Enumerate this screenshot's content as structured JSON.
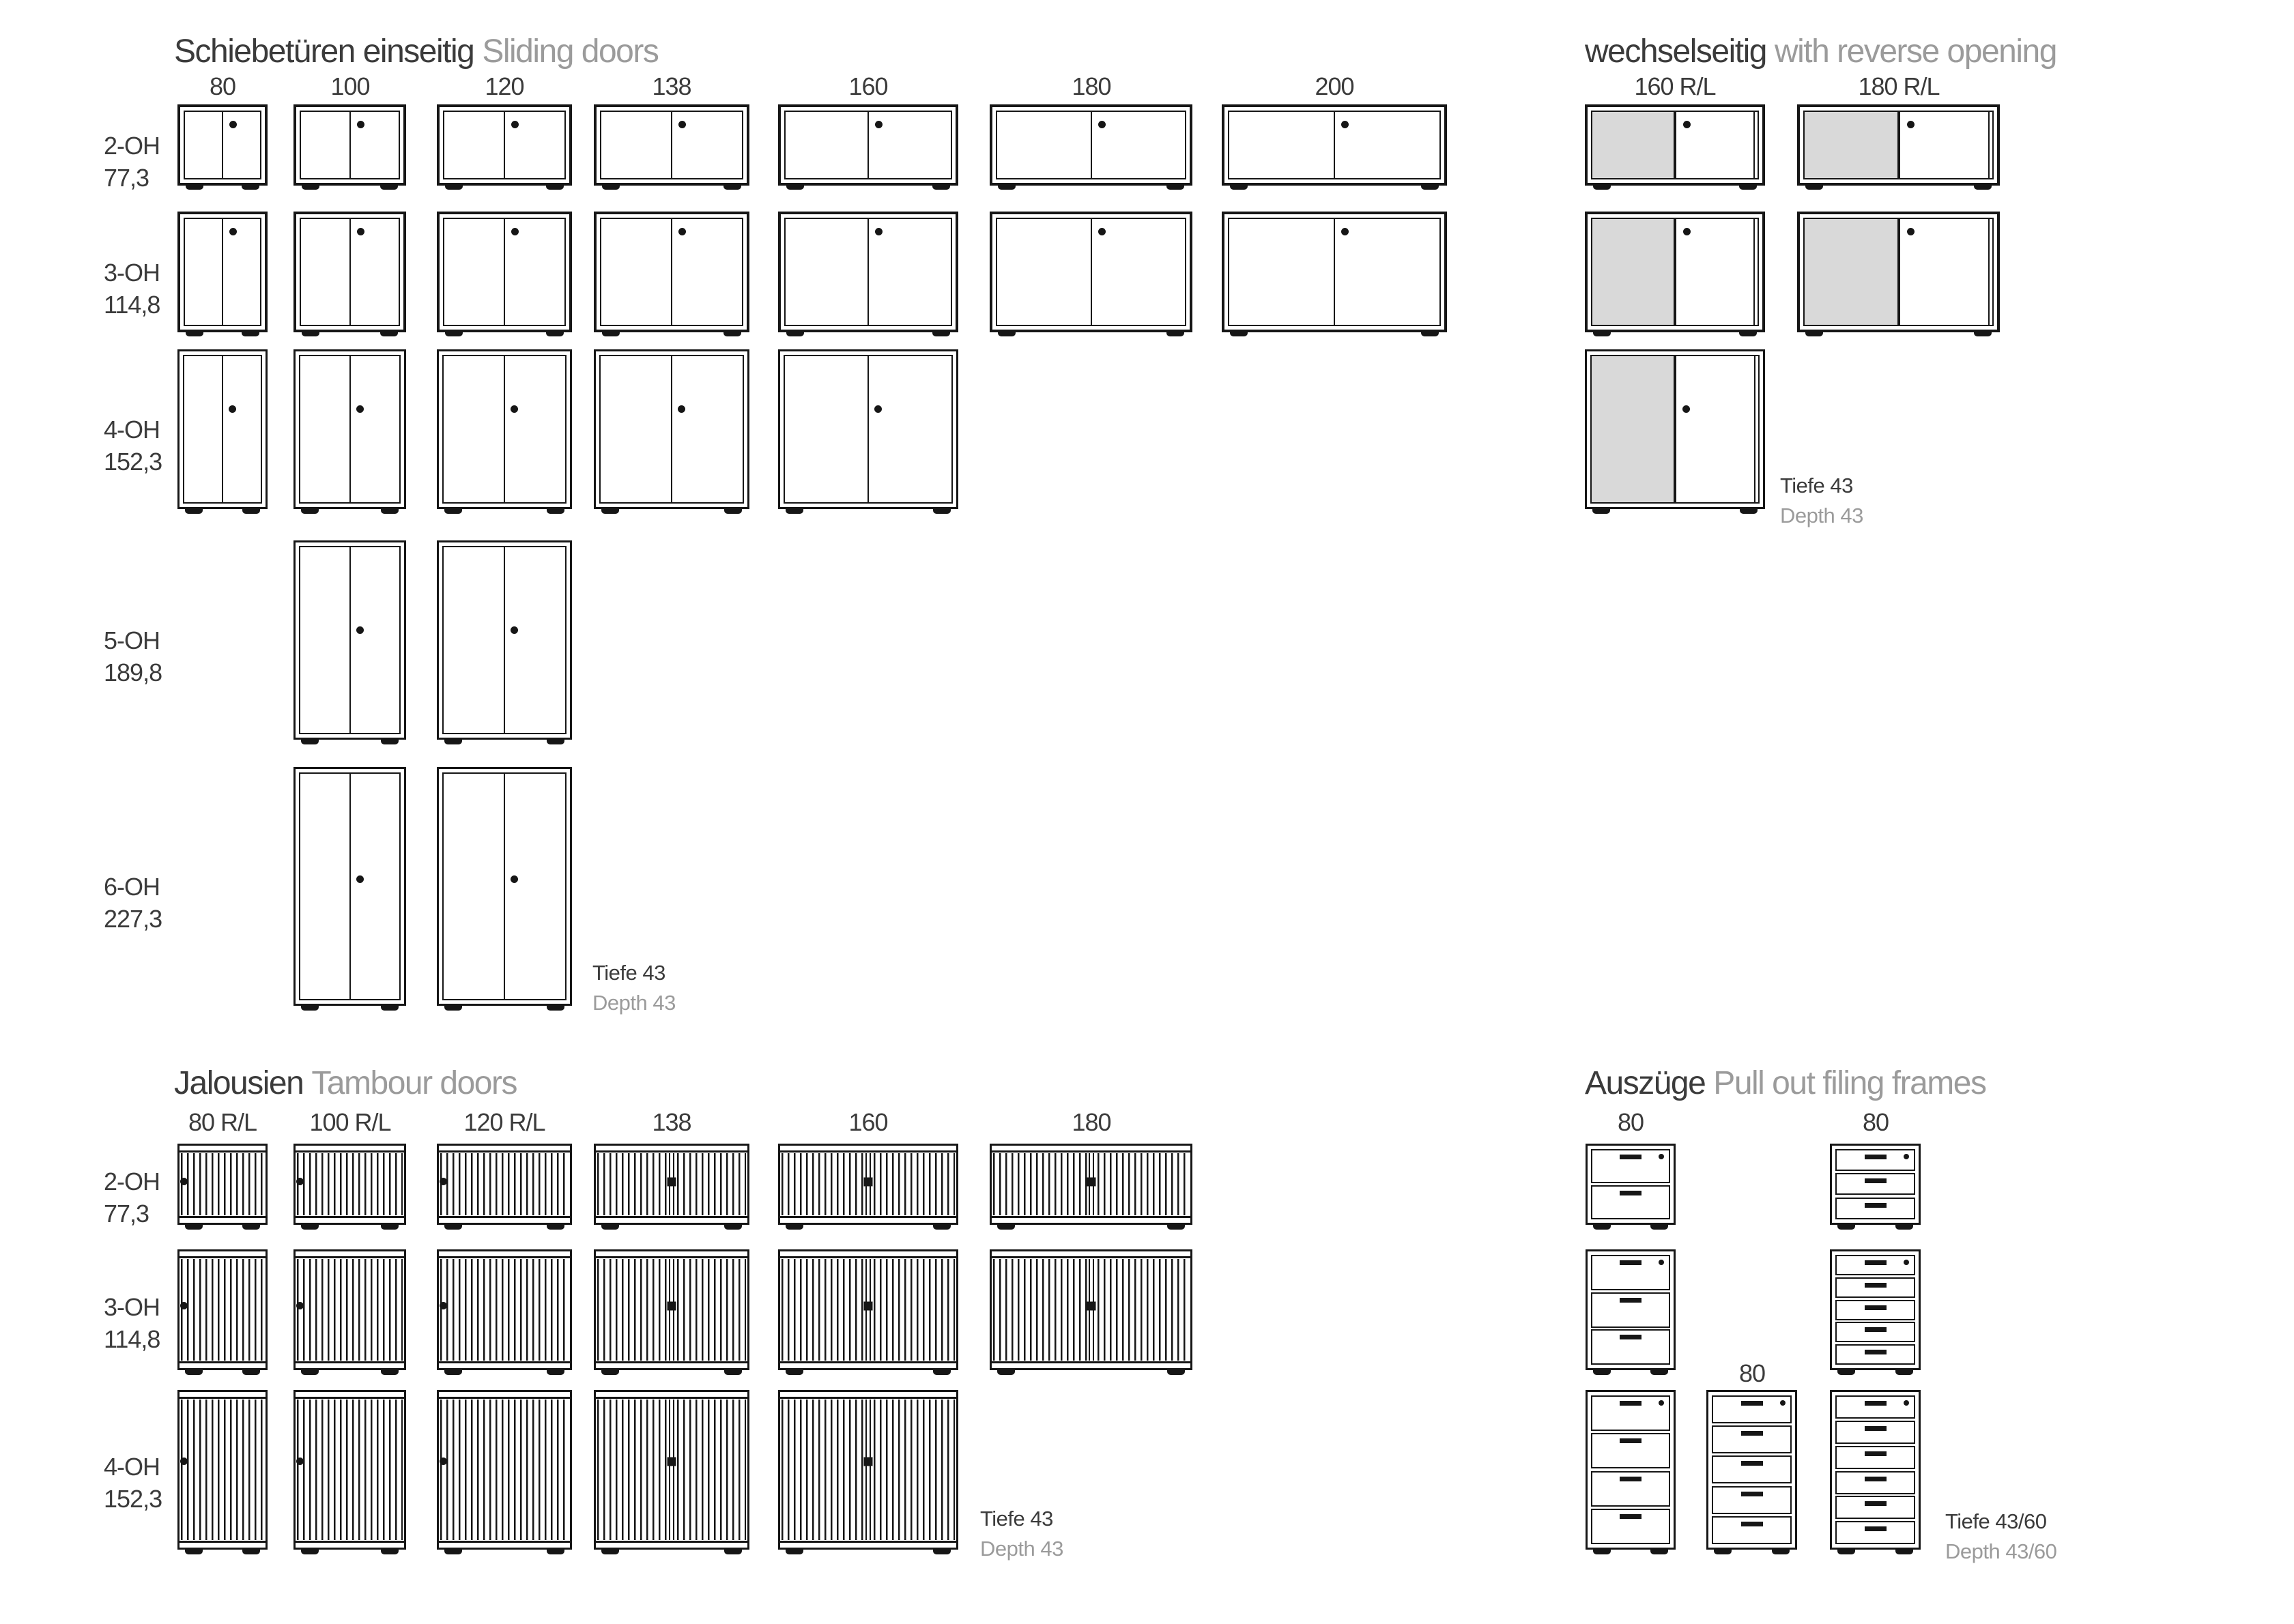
{
  "colors": {
    "ink": "#161616",
    "text_dark": "#3b3b3b",
    "text_gray": "#9b9b9b",
    "door_gray": "#d9d9d9",
    "background": "#ffffff"
  },
  "sections": {
    "sliding": {
      "title_de": "Schiebetüren einseitig",
      "title_en": "Sliding doors",
      "columns": [
        "80",
        "100",
        "120",
        "138",
        "160",
        "180",
        "200"
      ],
      "rows": [
        {
          "oh": "2-OH",
          "height": "77,3",
          "present": [
            1,
            1,
            1,
            1,
            1,
            1,
            1
          ]
        },
        {
          "oh": "3-OH",
          "height": "114,8",
          "present": [
            1,
            1,
            1,
            1,
            1,
            1,
            1
          ]
        },
        {
          "oh": "4-OH",
          "height": "152,3",
          "present": [
            1,
            1,
            1,
            1,
            1,
            0,
            0
          ]
        },
        {
          "oh": "5-OH",
          "height": "189,8",
          "present": [
            0,
            1,
            1,
            0,
            0,
            0,
            0
          ]
        },
        {
          "oh": "6-OH",
          "height": "227,3",
          "present": [
            0,
            1,
            1,
            0,
            0,
            0,
            0
          ]
        }
      ],
      "depth_de": "Tiefe 43",
      "depth_en": "Depth 43"
    },
    "reverse": {
      "title_de": "wechselseitig",
      "title_en": "with reverse opening",
      "columns": [
        "160 R/L",
        "180 R/L"
      ],
      "rows": [
        {
          "oh": "2-OH",
          "present": [
            1,
            1
          ]
        },
        {
          "oh": "3-OH",
          "present": [
            1,
            1
          ]
        },
        {
          "oh": "4-OH",
          "present": [
            1,
            0
          ]
        }
      ],
      "depth_de": "Tiefe 43",
      "depth_en": "Depth 43"
    },
    "tambour": {
      "title_de": "Jalousien",
      "title_en": "Tambour doors",
      "columns": [
        "80 R/L",
        "100 R/L",
        "120 R/L",
        "138",
        "160",
        "180"
      ],
      "rows": [
        {
          "oh": "2-OH",
          "height": "77,3",
          "present": [
            1,
            1,
            1,
            1,
            1,
            1
          ]
        },
        {
          "oh": "3-OH",
          "height": "114,8",
          "present": [
            1,
            1,
            1,
            1,
            1,
            1
          ]
        },
        {
          "oh": "4-OH",
          "height": "152,3",
          "present": [
            1,
            1,
            1,
            1,
            1,
            0
          ]
        }
      ],
      "depth_de": "Tiefe 43",
      "depth_en": "Depth 43"
    },
    "filing": {
      "title_de": "Auszüge",
      "title_en": "Pull out filing frames",
      "columns": [
        "80",
        "80",
        "80"
      ],
      "rows": [
        {
          "oh": "2-OH",
          "cabinets": [
            {
              "col": 0,
              "drawers": 2
            },
            {
              "col": 2,
              "drawers": 3
            }
          ]
        },
        {
          "oh": "3-OH",
          "cabinets": [
            {
              "col": 0,
              "drawers": 3
            },
            {
              "col": 2,
              "drawers": 5
            }
          ]
        },
        {
          "oh": "4-OH",
          "cabinets": [
            {
              "col": 0,
              "drawers": 4
            },
            {
              "col": 1,
              "drawers": 5
            },
            {
              "col": 2,
              "drawers": 6
            }
          ]
        }
      ],
      "depth_de": "Tiefe 43/60",
      "depth_en": "Depth 43/60"
    }
  }
}
